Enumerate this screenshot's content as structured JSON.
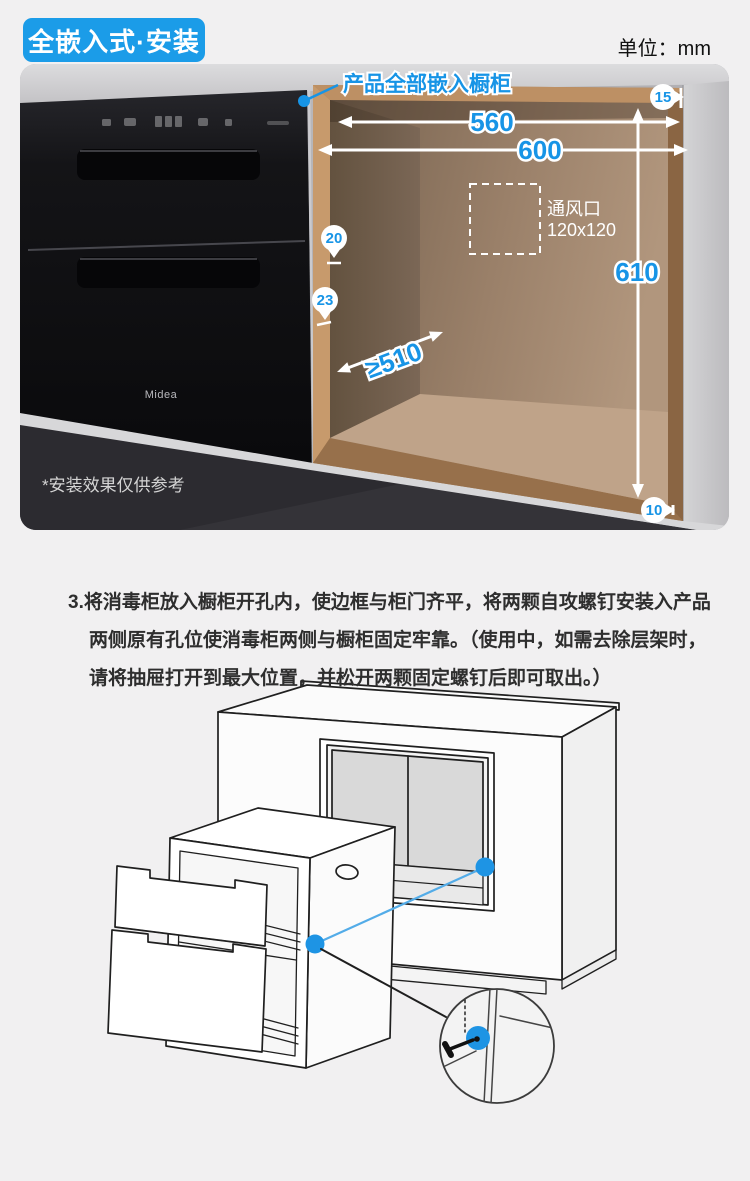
{
  "header": {
    "badge": "全嵌入式·安装",
    "unit": "单位：mm"
  },
  "photo": {
    "callout": "产品全部嵌入橱柜",
    "vent": {
      "line1": "通风口",
      "line2": "120x120"
    },
    "dims": {
      "inner_width": "560",
      "outer_width": "600",
      "height": "610",
      "depth": "≥510",
      "top_gap": "15",
      "side_gap": "20",
      "frame_overlap": "23",
      "bottom_gap": "10"
    },
    "brand": "Midea",
    "disclaimer": "*安装效果仅供参考"
  },
  "instructions": {
    "lines": [
      "3.将消毒柜放入橱柜开孔内，使边框与柜门齐平，将两颗自攻螺钉安装入产品",
      "两侧原有孔位使消毒柜两侧与橱柜固定牢靠。（使用中，如需去除层架时，",
      "请将抽屉打开到最大位置，并松开两颗固定螺钉后即可取出。）"
    ]
  },
  "colors": {
    "accent": "#1794e6",
    "badge_bg": "#1b9ce8",
    "wood": "#b08356",
    "counter_dark": "#3c3b3f"
  }
}
